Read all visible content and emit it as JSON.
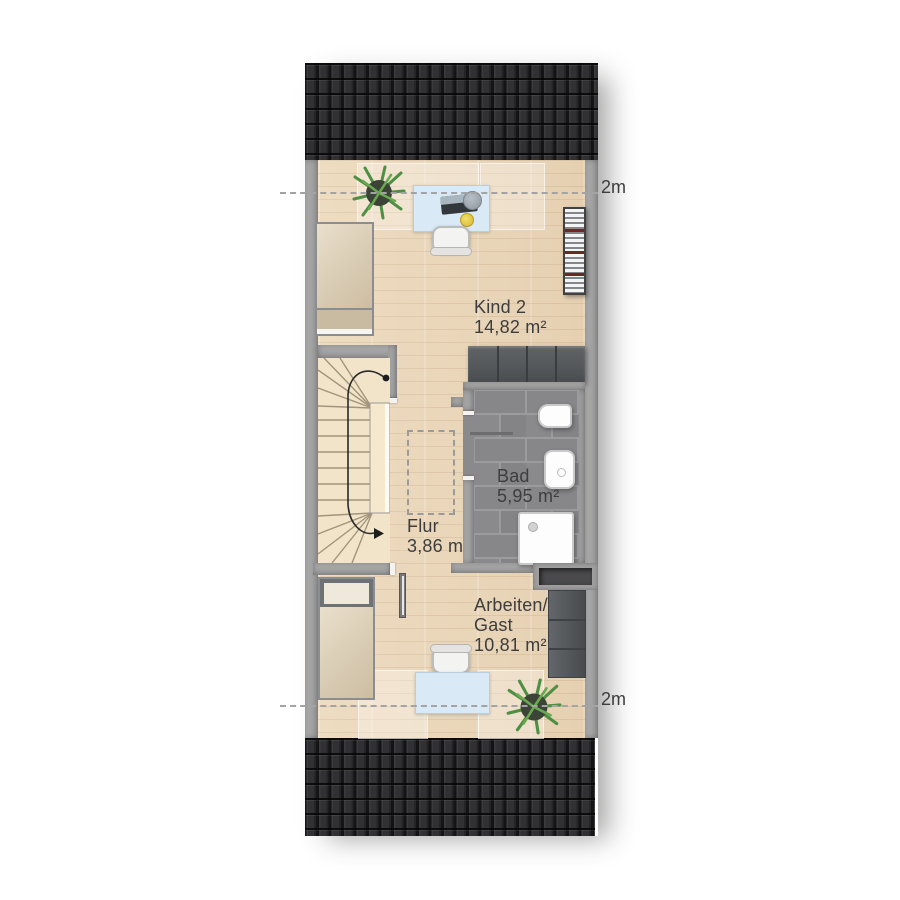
{
  "plan": {
    "title": "Dachgeschoss Grundriss",
    "rooms": {
      "kind2": {
        "name": "Kind 2",
        "area": "14,82 m²"
      },
      "flur": {
        "name": "Flur",
        "area": "3,86 m²"
      },
      "bad": {
        "name": "Bad",
        "area": "5,95 m²"
      },
      "arbeiten": {
        "name_line1": "Arbeiten/",
        "name_line2": "Gast",
        "area": "10,81 m²"
      }
    },
    "height_markers": {
      "top": "2m",
      "bottom": "2m"
    }
  },
  "colors": {
    "roof": "#232325",
    "wall": "#a6a6a6",
    "wood_floor": "#ecd8ba",
    "bath_tile": "#87878a",
    "furniture_dark": "#54575a",
    "desk_blue": "#d9eaf6",
    "label_text": "#3d3d3d"
  }
}
